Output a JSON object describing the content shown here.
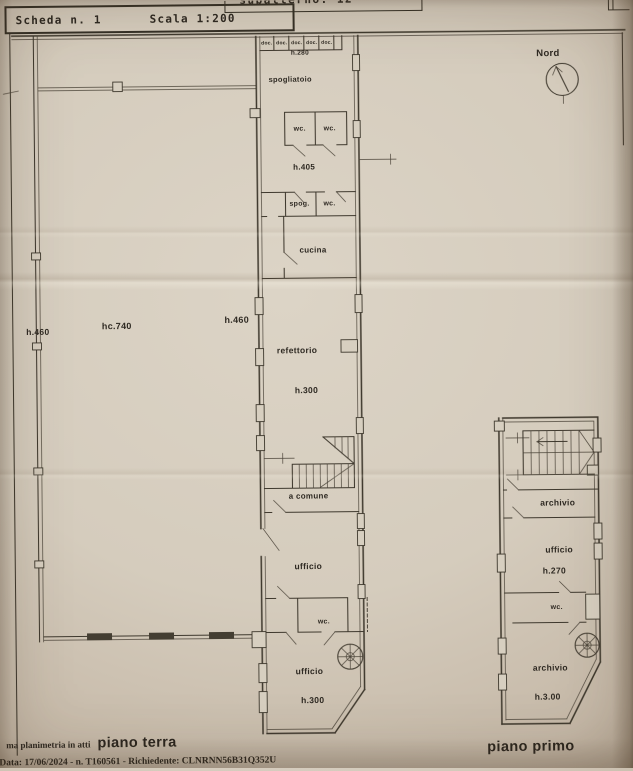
{
  "header": {
    "scheda": "Scheda n. 1",
    "scala": "Scala 1:200",
    "subalterno_clipped": "subalterno: 12"
  },
  "compass": {
    "label": "Nord"
  },
  "piano_terra": {
    "doc_labels": [
      "doc.",
      "doc.",
      "doc.",
      "doc.",
      "doc."
    ],
    "h280": "h.280",
    "spogliatoio": "spogliatoio",
    "wc_top_1": "wc.",
    "wc_top_2": "wc.",
    "h405": "h.405",
    "spog": "spog.",
    "wc_mid": "wc.",
    "cucina": "cucina",
    "refettorio": "refettorio",
    "h300_refettorio": "h.300",
    "a_comune": "a comune",
    "ufficio_1": "ufficio",
    "wc_lower": "wc.",
    "ufficio_2": "ufficio",
    "h300_ufficio": "h.300",
    "h460_left": "h.460",
    "hc740": "hc.740",
    "h460_right": "h.460"
  },
  "piano_primo": {
    "archivio_1": "archivio",
    "ufficio": "ufficio",
    "h270": "h.270",
    "wc": "wc.",
    "archivio_2": "archivio",
    "h300": "h.3.00"
  },
  "footer": {
    "atti_note": "ma planimetria in atti",
    "piano_terra_label": "piano terra",
    "data_line": "Data: 17/06/2024 - n. T160561 - Richiedente: CLNRNN56B31Q352U",
    "piano_primo_label": "piano primo"
  }
}
